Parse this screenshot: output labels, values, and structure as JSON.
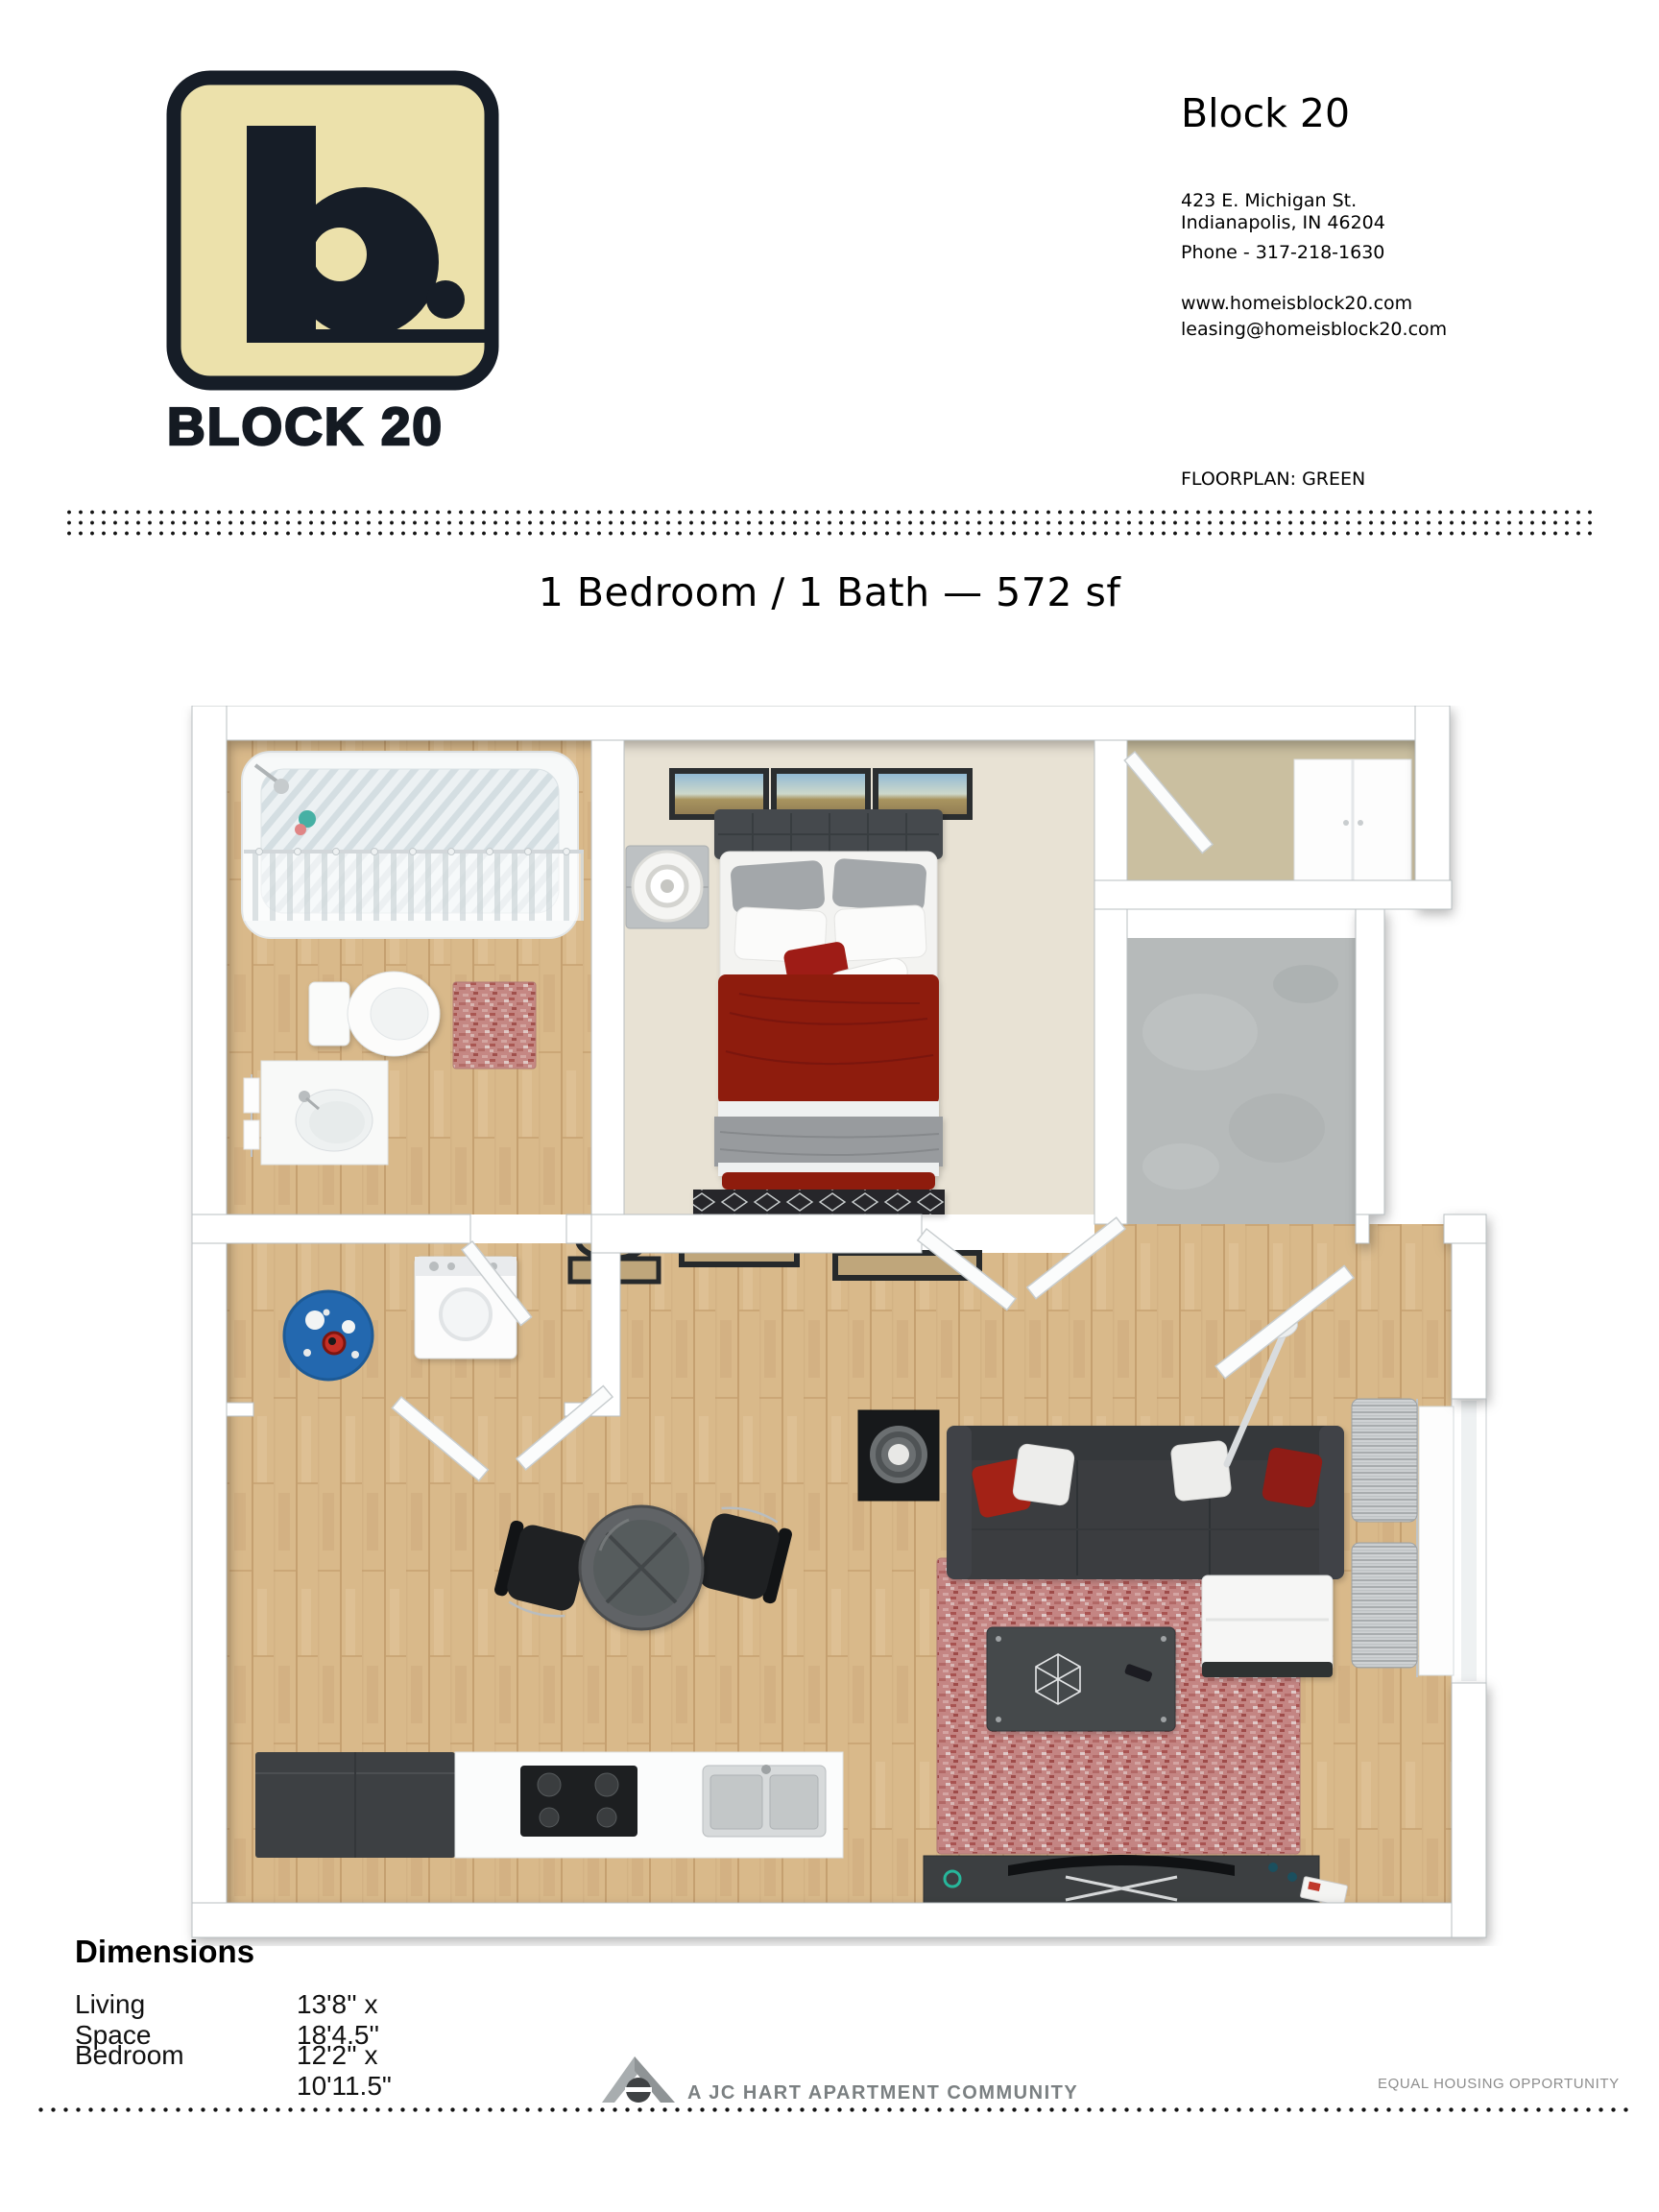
{
  "logo": {
    "brand": "BLOCK 20",
    "monogram": "b."
  },
  "header": {
    "property_name": "Block 20",
    "address_line1": "423 E. Michigan St.",
    "address_line2": "Indianapolis, IN 46204",
    "phone": "Phone - 317-218-1630",
    "website": "www.homeisblock20.com",
    "email": "leasing@homeisblock20.com",
    "floorplan_label": "FLOORPLAN: GREEN"
  },
  "floorplan": {
    "title": "1 Bedroom / 1 Bath — 572 sf",
    "name": "GREEN",
    "rooms": [
      "bathroom",
      "bedroom",
      "closet",
      "entry",
      "laundry",
      "living-dining",
      "kitchen"
    ],
    "furniture_icons": [
      "bathtub-icon",
      "shower-curtain-icon",
      "toilet-icon",
      "vanity-sink-icon",
      "bath-rug-icon",
      "bed-icon",
      "nightstand-lamp-icon",
      "wall-art-icon",
      "wardrobe-icon",
      "washer-icon",
      "laundry-rug-icon",
      "dining-table-icon",
      "dining-chair-icon",
      "side-table-icon",
      "sofa-icon",
      "ottoman-icon",
      "area-rug-icon",
      "coffee-table-icon",
      "tv-console-icon",
      "curtains-icon",
      "kitchen-cabinets-icon",
      "stove-icon",
      "kitchen-sink-icon",
      "door-icon",
      "arc-lamp-icon"
    ]
  },
  "dimensions": {
    "heading": "Dimensions",
    "rows": [
      {
        "label": "Living Space",
        "value": "13'8'' x 18'4.5''"
      },
      {
        "label": "Bedroom",
        "value": "12'2'' x 10'11.5\""
      }
    ]
  },
  "footer": {
    "community": "A JC HART APARTMENT COMMUNITY",
    "equal_housing": "EQUAL HOUSING OPPORTUNITY"
  },
  "colors": {
    "logo_cream": "#ece1ab",
    "logo_ink": "#161d27",
    "wood_floor": "#d9b98a",
    "carpet": "#e8e2d4",
    "concrete": "#b6baba",
    "sofa": "#3a3d3f",
    "bedding_red": "#8e1a10",
    "rug_red": "#c48583",
    "rug_blue": "#2368af",
    "footer_gray": "#7b8082"
  }
}
